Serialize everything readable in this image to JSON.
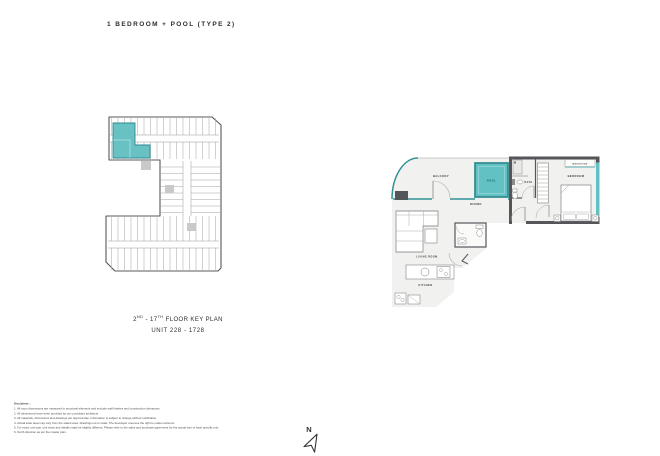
{
  "page": {
    "title": "1 BEDROOM + POOL (TYPE 2)"
  },
  "key_plan": {
    "caption": {
      "floor_prefix": "2",
      "floor_prefix_sup": "ND",
      "floor_mid": " - 17",
      "floor_mid_sup": "TH",
      "floor_suffix": " FLOOR KEY PLAN",
      "unit_range": "UNIT 228 - 1728"
    }
  },
  "unit_plan": {
    "labels": {
      "balcony": "BALCONY",
      "pool": "POOL",
      "bath": "BATH",
      "bedroom": "BEDROOM",
      "wardrobe": "WARDROBE",
      "dining": "DINING",
      "living_room": "LIVING ROOM",
      "kitchen": "KITCHEN"
    }
  },
  "compass": {
    "north_label": "N"
  },
  "disclaimer": {
    "heading": "Disclaimer :",
    "lines": [
      "1. All room dimensions are measured to structural elements and exclude wall finishes and construction tolerances.",
      "2. All dimensions have been provided by our consultant architects.",
      "3. All materials, dimensions and drawings are approximate. Information is subject to change without notification.",
      "4. Actual suite area may vary from the stated area. Drawings not to scale. The developer reserves the right to make revisions.",
      "5. For exact unit type, unit sizes and details might be slightly different. Please refer to the sales and purchase agreement for the actual size of each specific unit.",
      "6. North direction as per the master plan."
    ]
  },
  "colors": {
    "accent_teal": "#62C1C3",
    "teal_dark": "#2E8A8E",
    "glass_teal": "#2F9396",
    "wall_gray": "#54565A",
    "floor_gray": "#F1F1EF"
  }
}
